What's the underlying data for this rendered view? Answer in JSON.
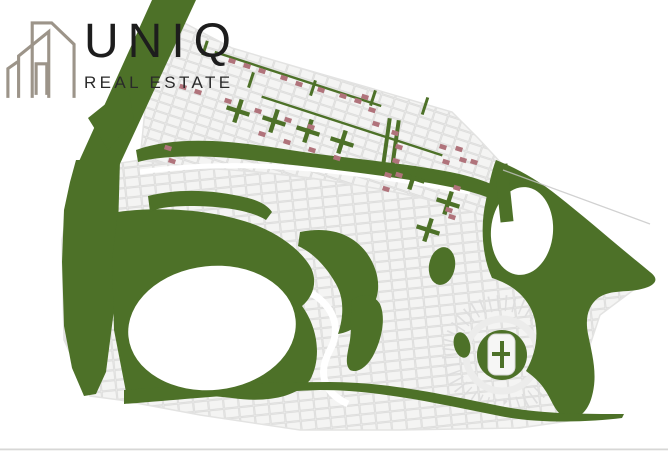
{
  "logo": {
    "brand": "UNIQ",
    "tagline": "REAL ESTATE",
    "icon": "buildings-outline-icon"
  },
  "colors": {
    "background": "#ffffff",
    "landscape_green": "#4d7128",
    "plot_cell_fill": "#f4f4f3",
    "plot_cell_border": "#d9d9d8",
    "street_white": "#ffffff",
    "sold_plot_red": "#b0737b",
    "boundary_line_gray": "#c6c6c6",
    "bottom_edge_gray": "#d7d7d6",
    "logo_icon_taupe": "#9c9489",
    "logo_text_black": "#1d1d1d"
  },
  "map": {
    "type": "master-plan-site-map",
    "row_angle_deg": 18,
    "sold_plots": [
      [
        232,
        61
      ],
      [
        247,
        66
      ],
      [
        262,
        71
      ],
      [
        284,
        78
      ],
      [
        299,
        84
      ],
      [
        321,
        90
      ],
      [
        343,
        96
      ],
      [
        358,
        101
      ],
      [
        183,
        87
      ],
      [
        198,
        92
      ],
      [
        228,
        101
      ],
      [
        258,
        111
      ],
      [
        288,
        120
      ],
      [
        311,
        127
      ],
      [
        262,
        134
      ],
      [
        287,
        142
      ],
      [
        312,
        150
      ],
      [
        337,
        158
      ],
      [
        168,
        148
      ],
      [
        172,
        161
      ],
      [
        365,
        97
      ],
      [
        372,
        110
      ],
      [
        376,
        124
      ],
      [
        395,
        133
      ],
      [
        399,
        147
      ],
      [
        396,
        161
      ],
      [
        399,
        175
      ],
      [
        388,
        175
      ],
      [
        386,
        189
      ],
      [
        443,
        147
      ],
      [
        459,
        149
      ],
      [
        446,
        162
      ],
      [
        463,
        160
      ],
      [
        474,
        162
      ],
      [
        457,
        188
      ],
      [
        449,
        210
      ],
      [
        452,
        217
      ]
    ],
    "pocket_park_crosses": [
      [
        238,
        111
      ],
      [
        274,
        121
      ],
      [
        308,
        131
      ],
      [
        342,
        142
      ],
      [
        413,
        178
      ],
      [
        448,
        203
      ],
      [
        428,
        230
      ]
    ],
    "green_divider_bars": [
      [
        205,
        48,
        3,
        15,
        18
      ],
      [
        251,
        80,
        3,
        16,
        18
      ],
      [
        313,
        88,
        3,
        16,
        18
      ],
      [
        373,
        98,
        3,
        16,
        18
      ],
      [
        425,
        106,
        3,
        18,
        18
      ],
      [
        386,
        145,
        4,
        54,
        8
      ],
      [
        395,
        147,
        4,
        54,
        8
      ],
      [
        504,
        193,
        13,
        58,
        -6
      ],
      [
        298,
        79,
        175,
        2.4,
        18
      ],
      [
        352,
        126,
        190,
        2.4,
        18
      ]
    ]
  }
}
